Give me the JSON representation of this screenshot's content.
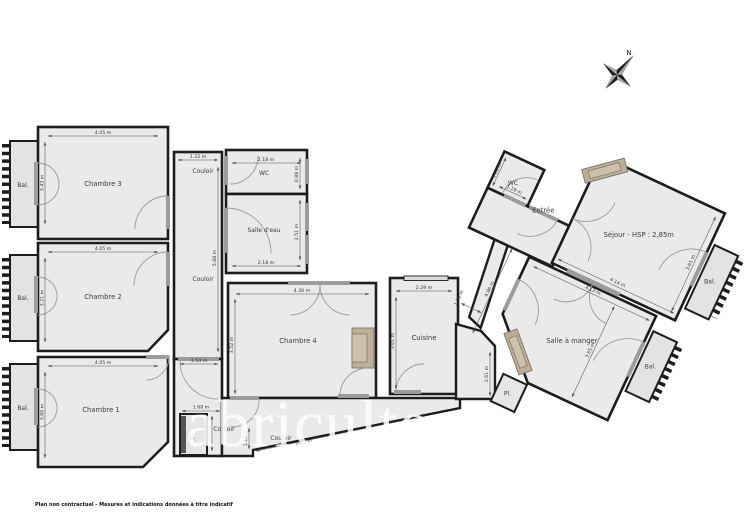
{
  "plan": {
    "watermark": "abriculteurs",
    "footer": "Plan non contractuel - Mesures et indications données à titre indicatif",
    "north_label": "N",
    "rooms": {
      "chambre1": {
        "name": "Chambre 1",
        "width": "4.05 m",
        "height": "3.06 m"
      },
      "chambre2": {
        "name": "Chambre 2",
        "width": "4.05 m",
        "height": "3.21 m"
      },
      "chambre3": {
        "name": "Chambre 3",
        "width": "4.05 m",
        "height": "3.43 m"
      },
      "chambre4": {
        "name": "Chambre 4",
        "width": "4.30 m",
        "height": "3.52 m"
      },
      "cuisine": {
        "name": "Cuisine",
        "width": "2.29 m",
        "height": "3.01 m"
      },
      "wc_gauche": {
        "name": "WC",
        "width": "2.18 m",
        "height": "0.88 m"
      },
      "salle_eau": {
        "name": "Salle d'eau",
        "width": "2.18 m",
        "height": "2.51 m"
      },
      "wc_droit": {
        "name": "WC",
        "width": "1.19 m",
        "height": "1.01 m"
      },
      "entree": {
        "name": "Entrée"
      },
      "sejour": {
        "name": "Séjour - HSP : 2,85m",
        "width": "4.14 m",
        "height": "3.61 m"
      },
      "salle_a_manger": {
        "name": "Salle à manger",
        "width": "4.13 m",
        "height": "3.65 m"
      },
      "couloir": {
        "name": "Couloir",
        "width": "1.22 m",
        "length": "5.88 m"
      },
      "couloir_bas": {
        "name": "Couloir",
        "length": "2.95 m",
        "width": "1.10 m"
      },
      "balcon": {
        "name": "Bal."
      },
      "placard": {
        "name": "Pl."
      }
    },
    "dims": {
      "porte": "1.54 m",
      "placard_largeur": "1.68 m",
      "placard_hauteur": "2.17 m",
      "degagement": "2.61 m",
      "couloir_diagonale": "4.86 m",
      "couloir_entree_largeur": "1.29 m"
    }
  }
}
